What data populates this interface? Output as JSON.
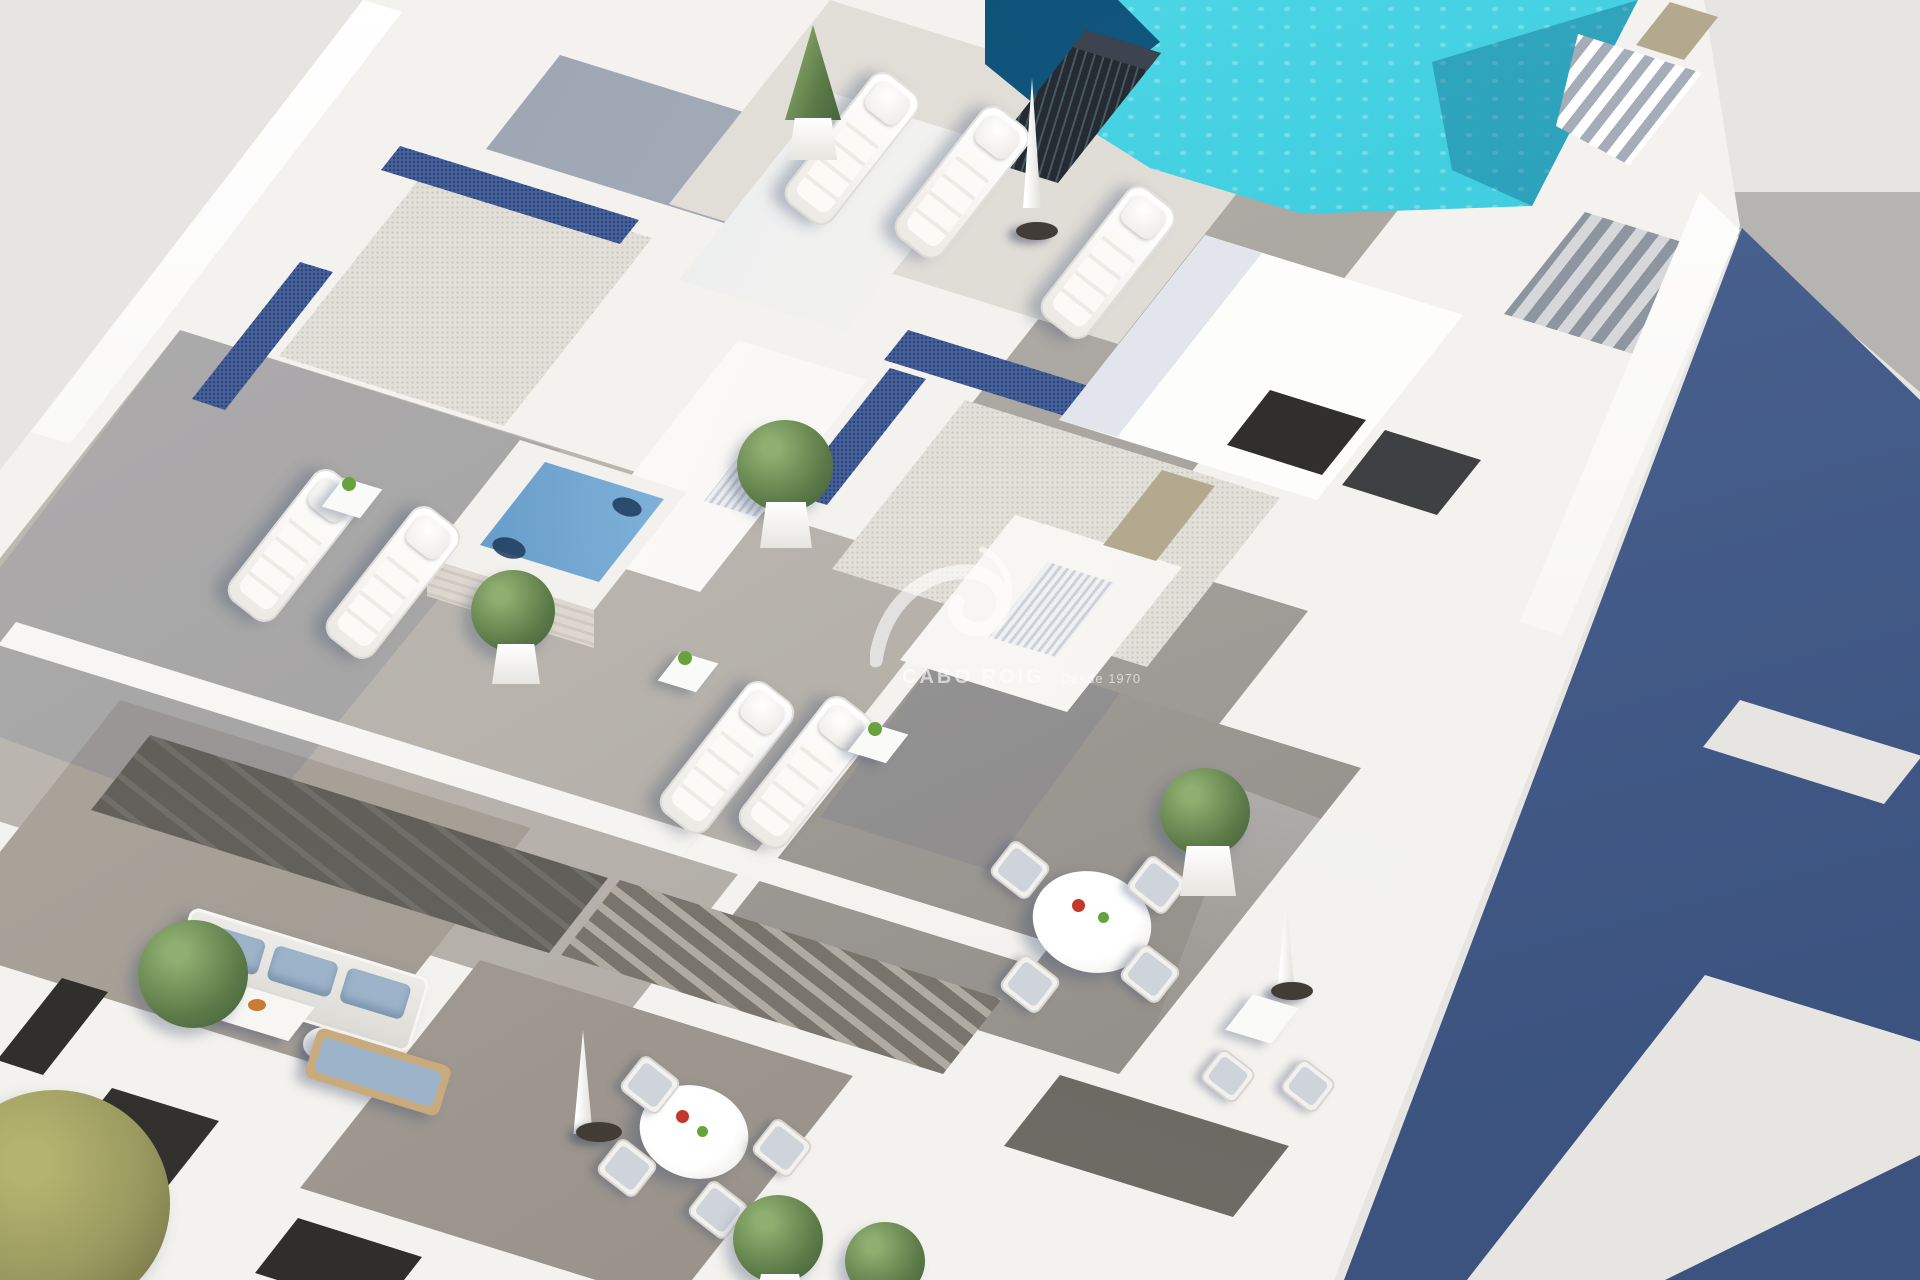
{
  "scene": {
    "type": "architectural-3d-render",
    "description": "Aerial render of a white apartment building rooftop solarium with swimming pool, jacuzzi, sun loungers, terraces and balconies; long blue shadow cast on the ground to the right",
    "objects": [
      "rooftop-pool",
      "jacuzzi",
      "sun-loungers",
      "closed-parasols",
      "round-dining-tables",
      "terrace-chairs",
      "planter-bushes",
      "pebble-gravel-roofs",
      "blue-pebble-strips",
      "wood-deck-terraces",
      "lower-floor-balconies",
      "outdoor-sofa",
      "ventilation-chimney",
      "pool-stairs",
      "cast-shadow-wall"
    ]
  },
  "watermark": {
    "brand": "CABO ROIG",
    "tagline": "Desde 1970"
  },
  "palette": {
    "background": "#e7e5e1",
    "building_white": "#f4f2ee",
    "wall_bright": "#fdfdfb",
    "wall_shade": "#e2e6ec",
    "deck_light": "#d8d5cf",
    "deck_mid": "#b4b0a9",
    "deck_dark": "#938f8a",
    "deck_shadow_blue": "#97a0af",
    "gravel": "#e3e0da",
    "gravel_dot": "#c9c6bf",
    "pebble_blue": "#44609b",
    "pool_teal": "#3ecddf",
    "pool_teal_dark": "#17a0bf",
    "pool_deep": "#0d4a70",
    "jacuzzi_blue": "#4079ae",
    "jacuzzi_light": "#8fc0e4",
    "shadow_wall": "#4c6492",
    "shadow_wall_dark": "#3c5380",
    "neighbor_gray": "#b6b4b1",
    "facade_dark": "#4e4b46",
    "curtain_glass": "#7a776f",
    "window_dark": "#312f2c",
    "door_tan": "#b3a98f",
    "plant_green": "#5d7c49",
    "plant_light": "#8fae70",
    "olive_green": "#9a9960",
    "wood_tan": "#c9aa7d",
    "cushion_blue": "#9db3c9",
    "umbrella_base": "#413c36",
    "accent_red": "#c4372b",
    "accent_green": "#67a23c",
    "fruit_orange": "#c97b35"
  }
}
